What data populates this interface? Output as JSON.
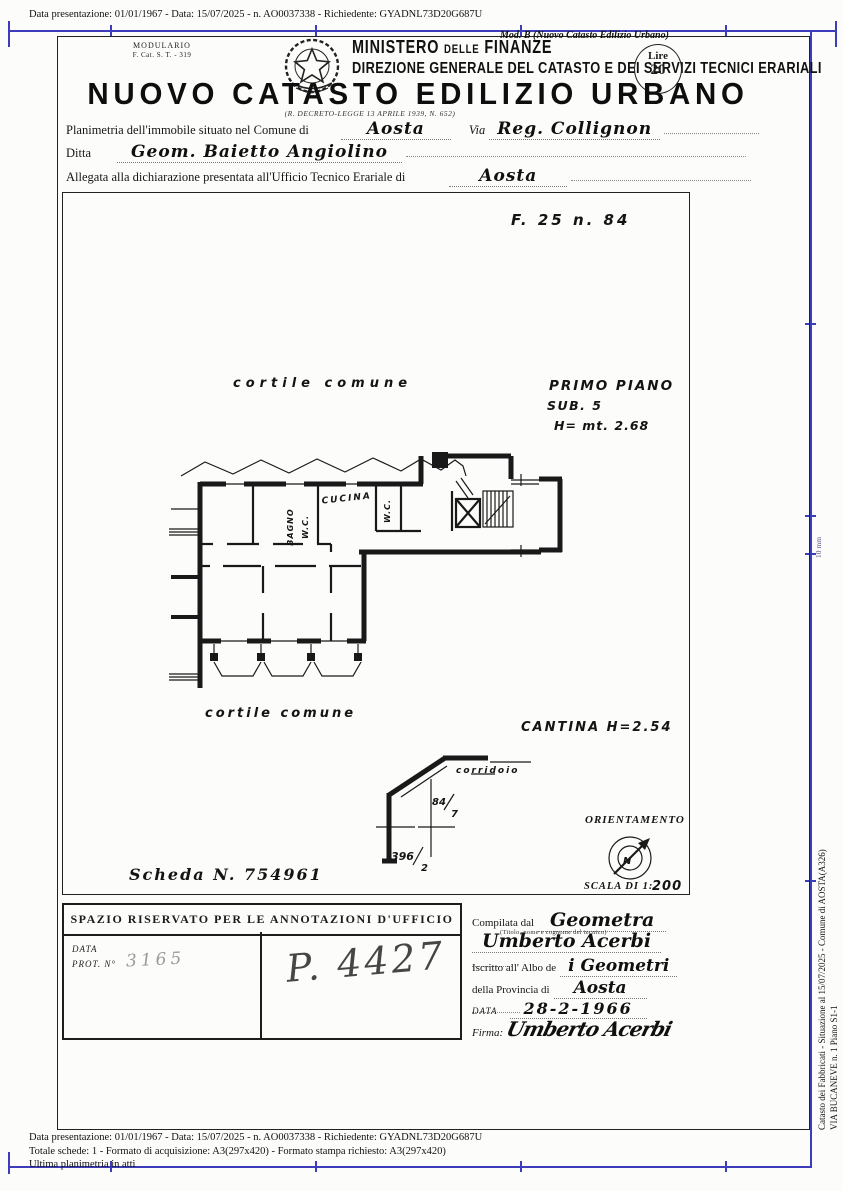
{
  "colors": {
    "blue": "#3d3dbb",
    "ink": "#1c1c1c",
    "paper": "#fcfcfa"
  },
  "top_strip": {
    "text": "Data presentazione: 01/01/1967 - Data: 15/07/2025 - n. AO0037338 - Richiedente: GYADNL73D20G687U"
  },
  "frame": {
    "ruler_label": "10 mm"
  },
  "side_text": {
    "line1": "Catasto dei Fabbricati - Situazione al 15/07/2025 - Comune di AOSTA(A326)",
    "line2": "VIA BUCANEVE n. 1 Piano S1-1"
  },
  "header": {
    "modulario_line1": "MODULARIO",
    "modulario_line2": "F.  Cat. S. T. - 319",
    "mod_b": "Mod. B (Nuovo Catasto Edilizio Urbano)",
    "ministry_a": "MINISTERO",
    "ministry_b": "DELLE",
    "ministry_c": "FINANZE",
    "ministry_line2": "DIREZIONE GENERALE DEL CATASTO E DEI SERVIZI TECNICI ERARIALI",
    "stamp_top": "Lire",
    "stamp_value": "20",
    "title": "NUOVO CATASTO EDILIZIO URBANO",
    "subtitle": "(R. DECRETO-LEGGE 13 APRILE 1939, N. 652)"
  },
  "fields": {
    "comune_label": "Planimetria dell'immobile situato nel Comune di",
    "comune_value": "Aosta",
    "via_label": "Via",
    "via_value": "Reg. Collignon",
    "ditta_label": "Ditta",
    "ditta_value": "Geom. Baietto Angiolino",
    "ufficio_label": "Allegata alla dichiarazione presentata all'Ufficio Tecnico Erariale di",
    "ufficio_value": "Aosta"
  },
  "drawing": {
    "map_ref": "F. 25  n. 84",
    "courtyard_top": "cortile   comune",
    "floor_title": "PRIMO PIANO",
    "sub": "SUB. 5",
    "height": "H= mt. 2.68",
    "room_bagno": "BAGNO",
    "room_wc1": "W.C.",
    "room_cucina": "CUCINA",
    "room_wc2": "W.C.",
    "courtyard_bottom": "cortile comune",
    "cantina": "CANTINA  H=2.54",
    "corridoio": "corridoio",
    "parcel_a_num": "84",
    "parcel_a_den": "7",
    "parcel_b_num": "396",
    "parcel_b_den": "2",
    "orientamento": "ORIENTAMENTO",
    "north": "N",
    "scala_label": "SCALA DI 1:",
    "scala_value": "200",
    "scheda": "Scheda N. 754961"
  },
  "annotations": {
    "header": "SPAZIO RISERVATO PER LE ANNOTAZIONI D'UFFICIO",
    "data_label": "DATA",
    "prot_label": "PROT. N°",
    "prot_value": "3165",
    "note": "P. 4427"
  },
  "compiler": {
    "compilata_label": "Compilata dal",
    "compilata_value": "Geometra",
    "caption": "(Titolo, nome e cognome del tecnico)",
    "name_value": "Umberto Acerbi",
    "albo_label": "Iscritto all' Albo de",
    "albo_value": "i  Geometri",
    "provincia_label": "della Provincia di",
    "provincia_value": "Aosta",
    "data_label": "DATA",
    "data_value": "28-2-1966",
    "firma_label": "Firma:",
    "firma_value": "Umberto Acerbi"
  },
  "bottom_strip": {
    "line1": "Data presentazione: 01/01/1967 - Data: 15/07/2025 - n. AO0037338 - Richiedente: GYADNL73D20G687U",
    "line2": "Totale schede: 1 - Formato di acquisizione: A3(297x420)  - Formato stampa richiesto: A3(297x420)",
    "line3": "Ultima planimetria in atti"
  }
}
